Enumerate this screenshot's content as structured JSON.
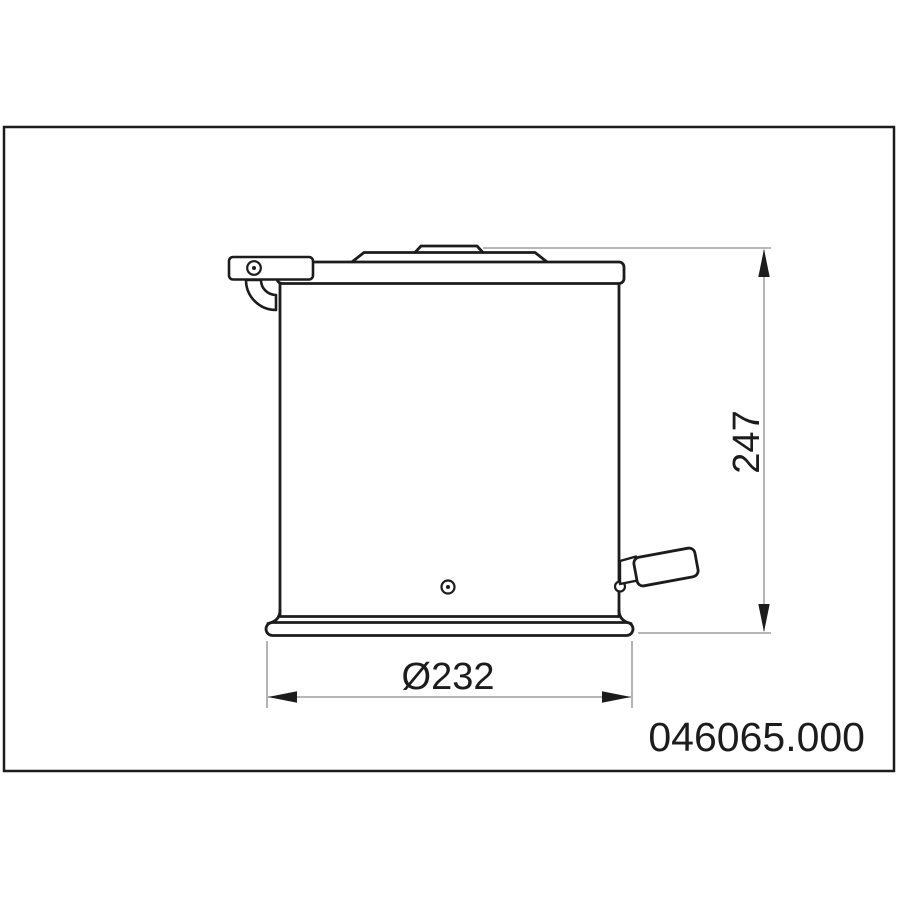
{
  "drawing": {
    "watermark": "select-interiorworld.com",
    "product_code": "046065.000",
    "dimensions": {
      "height": "247",
      "diameter": "Ø232"
    }
  },
  "colors": {
    "outline": "#1c1c1c",
    "dimension_line": "#8c8c8c",
    "text": "#1c1c1c",
    "watermark": "#acacac",
    "background": "#ffffff"
  }
}
